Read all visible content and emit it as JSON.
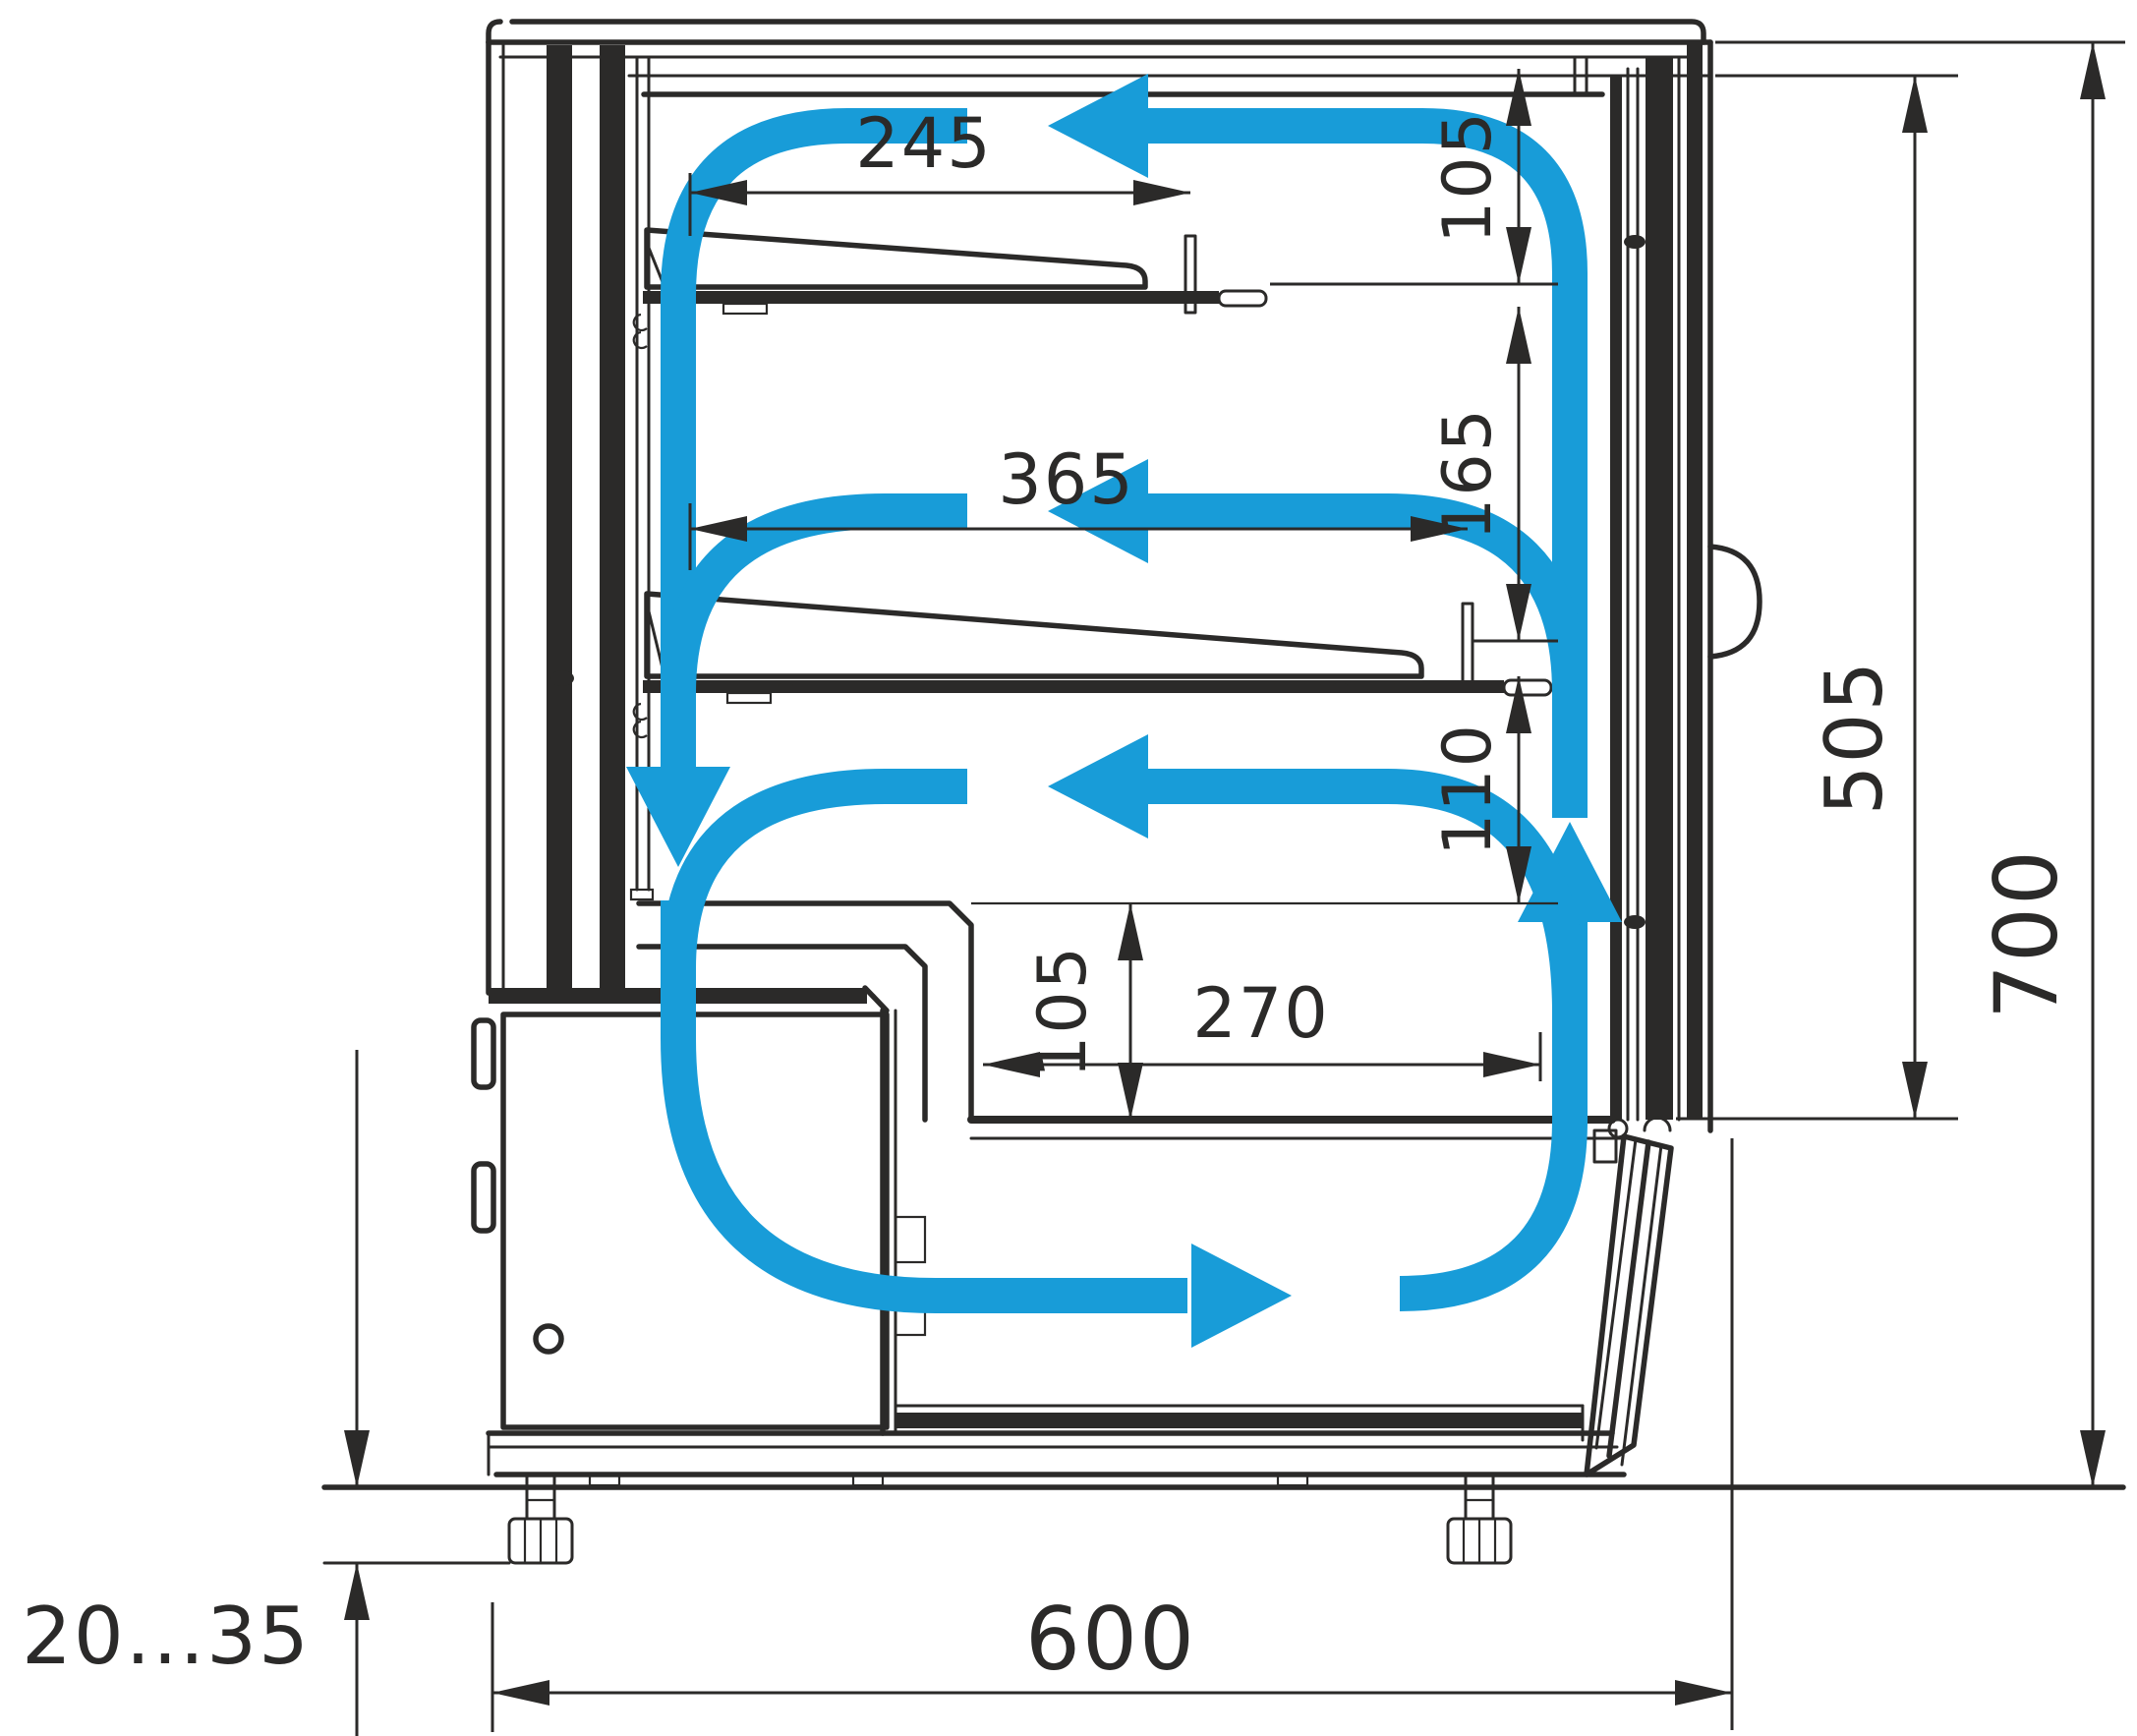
{
  "diagram": {
    "type": "technical-cross-section",
    "subject": "refrigerated confectionery display case - side section with airflow circulation",
    "line_color": "#2b2a29",
    "airflow_color": "#189cd8",
    "units": "mm",
    "labels": {
      "shelf_top_depth": "245",
      "shelf_middle_depth": "365",
      "gap_under_canopy": "105",
      "gap_between_shelves": "165",
      "gap_above_well": "110",
      "well_depth": "105",
      "well_bottom_depth": "270",
      "glass_front_height": "505",
      "overall_inner_height": "700",
      "base_depth": "600",
      "foot_adjustment_range": "20...35"
    }
  }
}
